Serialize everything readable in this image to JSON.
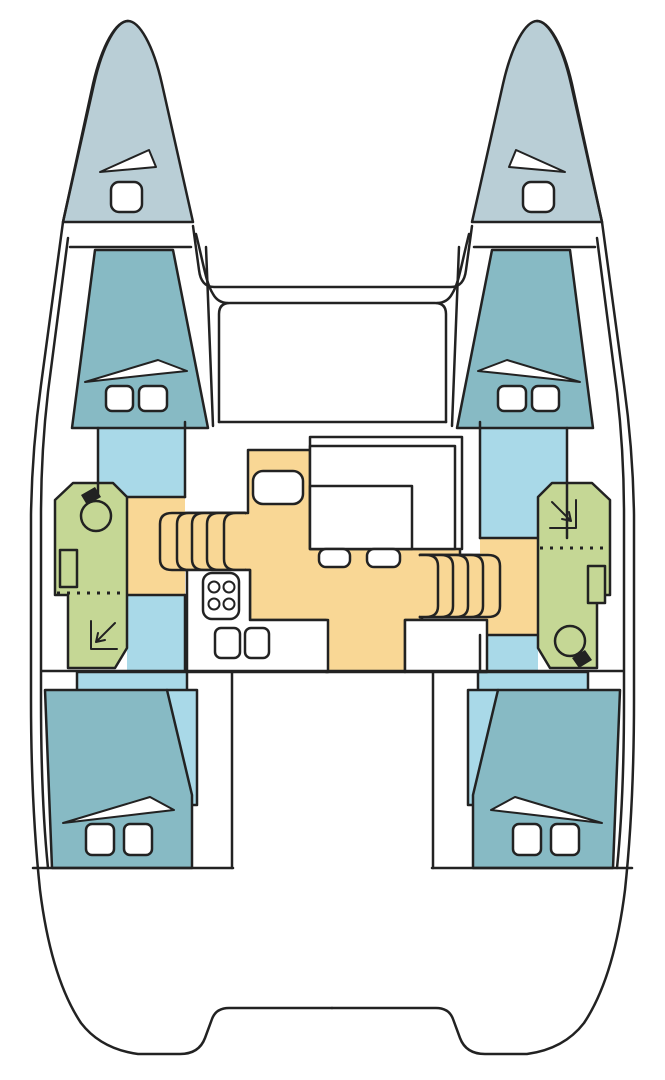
{
  "diagram": {
    "title": "Catamaran deck floor plan",
    "type": "floor-plan",
    "colors": {
      "outline": "#222222",
      "hull_white": "#ffffff",
      "bow_deck": "#b9ced6",
      "berth": "#87bac4",
      "corridor": "#a9d9e8",
      "bathroom": "#c5d795",
      "galley_floor": "#f9d795"
    },
    "rooms": [
      {
        "id": "port-bow-locker",
        "label": "Port bow locker",
        "color_key": "bow_deck"
      },
      {
        "id": "starboard-bow-locker",
        "label": "Starboard bow locker",
        "color_key": "bow_deck"
      },
      {
        "id": "port-forward-cabin",
        "label": "Port forward cabin",
        "color_key": "berth"
      },
      {
        "id": "starboard-forward-cabin",
        "label": "Starboard forward cabin",
        "color_key": "berth"
      },
      {
        "id": "port-head",
        "label": "Port bathroom with shower",
        "color_key": "bathroom"
      },
      {
        "id": "starboard-head",
        "label": "Starboard bathroom with shower",
        "color_key": "bathroom"
      },
      {
        "id": "saloon-galley",
        "label": "Saloon and galley",
        "color_key": "galley_floor"
      },
      {
        "id": "port-corridor",
        "label": "Port hull corridor",
        "color_key": "corridor"
      },
      {
        "id": "starboard-corridor",
        "label": "Starboard hull corridor",
        "color_key": "corridor"
      },
      {
        "id": "port-aft-cabin",
        "label": "Port aft cabin",
        "color_key": "berth"
      },
      {
        "id": "starboard-aft-cabin",
        "label": "Starboard aft cabin",
        "color_key": "berth"
      },
      {
        "id": "foredeck-cockpit",
        "label": "Forward cockpit",
        "color_key": "hull_white"
      },
      {
        "id": "aft-cockpit",
        "label": "Aft cockpit",
        "color_key": "hull_white"
      }
    ],
    "furniture": [
      "double-berth",
      "pillow",
      "duvet-fold",
      "deck-hatch",
      "companionway-stairs",
      "dinette-seat",
      "saloon-table",
      "stool",
      "stove-4-burner",
      "double-sink",
      "chart-table",
      "toilet",
      "washbasin",
      "shower-tray"
    ]
  }
}
